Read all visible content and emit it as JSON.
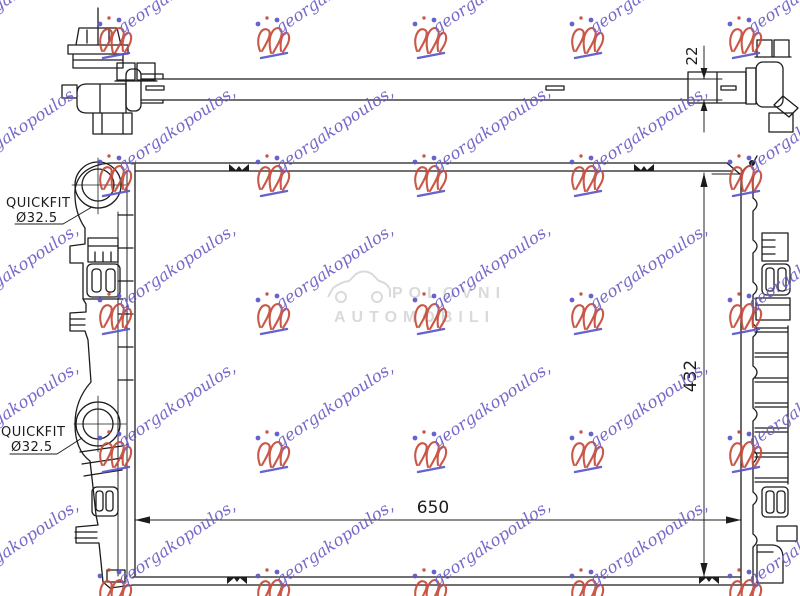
{
  "colors": {
    "line": "#1c1c1c"
  },
  "labels": {
    "quickfit_top": {
      "line1": "QUICKFIT",
      "line2": "Ø32.5"
    },
    "quickfit_bottom": {
      "line1": "QUICKFIT",
      "line2": "Ø32.5"
    }
  },
  "dimensions": {
    "core_width": "650",
    "core_height": "432",
    "crossbar_depth": "22"
  },
  "watermark": {
    "text": "georgakopoulos,",
    "text_color": "#6a5ec6",
    "logo_color": "#c64a38",
    "accent_color": "#5a55c8",
    "angle": -34,
    "grid_x": [
      -45,
      112,
      270,
      427,
      584,
      742
    ],
    "grid_y": [
      37,
      175,
      313,
      451,
      589
    ]
  },
  "photo_watermark": {
    "line1": "POLOVNI",
    "line2": "AUTOMOBILI",
    "color": "#d6d6d6"
  }
}
